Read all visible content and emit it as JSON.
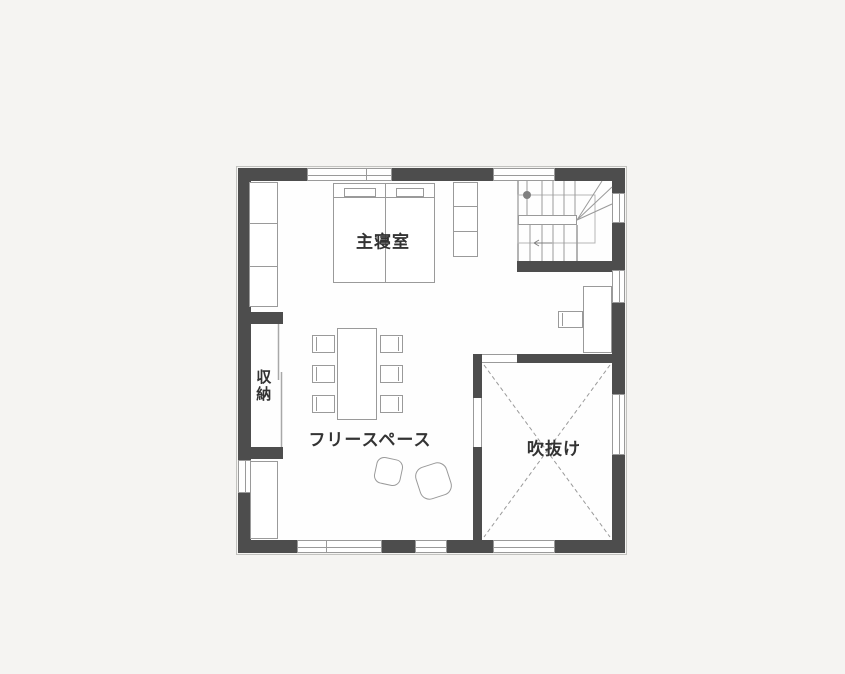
{
  "colors": {
    "background": "#f5f4f2",
    "floor": "#fefefe",
    "wall": "#4d4d4d",
    "line": "#9a9a9a",
    "text": "#333333"
  },
  "floor_plan": {
    "rooms": {
      "master_bedroom": {
        "label": "主寝室"
      },
      "storage": {
        "label": "収納"
      },
      "free_space": {
        "label": "フリースペース"
      },
      "void": {
        "label": "吹抜け"
      }
    }
  }
}
